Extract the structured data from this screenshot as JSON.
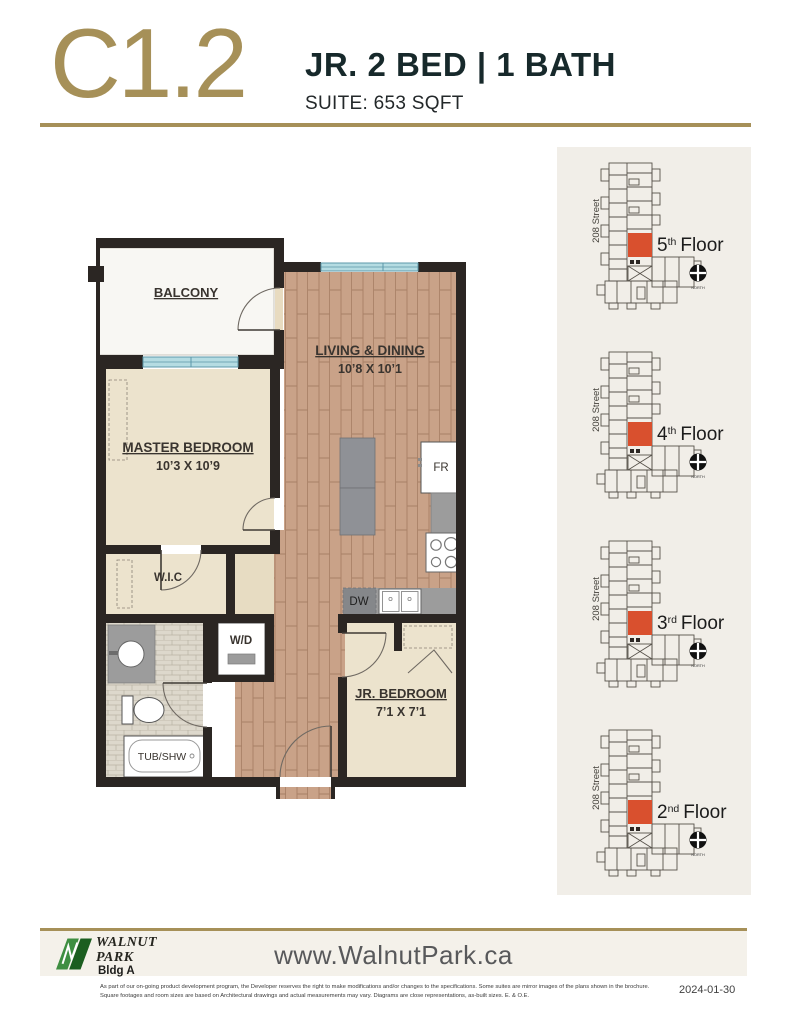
{
  "header": {
    "plan_code": "C1.2",
    "plan_type": "JR. 2 BED  |  1 BATH",
    "suite_label": "SUITE: 653 SQFT"
  },
  "floorplan": {
    "rooms": {
      "balcony": {
        "label": "BALCONY"
      },
      "living": {
        "label": "LIVING & DINING",
        "dims": "10’8 X 10’1"
      },
      "master": {
        "label": "MASTER BEDROOM",
        "dims": "10’3 X 10’9"
      },
      "wic": {
        "label": "W.I.C"
      },
      "jr": {
        "label": "JR. BEDROOM",
        "dims": "7’1 X 7’1"
      }
    },
    "fixtures": {
      "fridge": "FR",
      "dishwasher": "DW",
      "washer_dryer": "W/D",
      "tub": "TUB/SHW"
    }
  },
  "keyplans": {
    "street_label": "208 Street",
    "north_label": "NORTH",
    "floor_word": "Floor",
    "floors": [
      {
        "number": "5",
        "suffix": "th"
      },
      {
        "number": "4",
        "suffix": "th"
      },
      {
        "number": "3",
        "suffix": "rd"
      },
      {
        "number": "2",
        "suffix": "nd"
      }
    ]
  },
  "footer": {
    "logo": {
      "line1": "WALNUT",
      "line2": "PARK",
      "building": "Bldg A"
    },
    "website": "www.WalnutPark.ca",
    "disclaimer_line1": "As part of our on-going product development program, the Developer reserves the right to make modifications and/or changes to the specifications. Some suites are mirror images of the plans shown in the brochure.",
    "disclaimer_line2": "Square footages and room sizes are based on Architectural drawings and actual measurements may vary. Diagrams are close representations, as-built sizes. E. & O.E.",
    "date": "2024-01-30"
  },
  "colors": {
    "accent_gold": "#a69058",
    "heading_dark": "#17292b",
    "unit_highlight_red": "#d9502e",
    "wood_floor": "#c9a288",
    "room_beige": "#ece3cd",
    "panel_bg": "#f1eee8",
    "wall": "#2b2623",
    "window_cyan": "#b5dce2",
    "footer_band": "#f4f1ea"
  }
}
